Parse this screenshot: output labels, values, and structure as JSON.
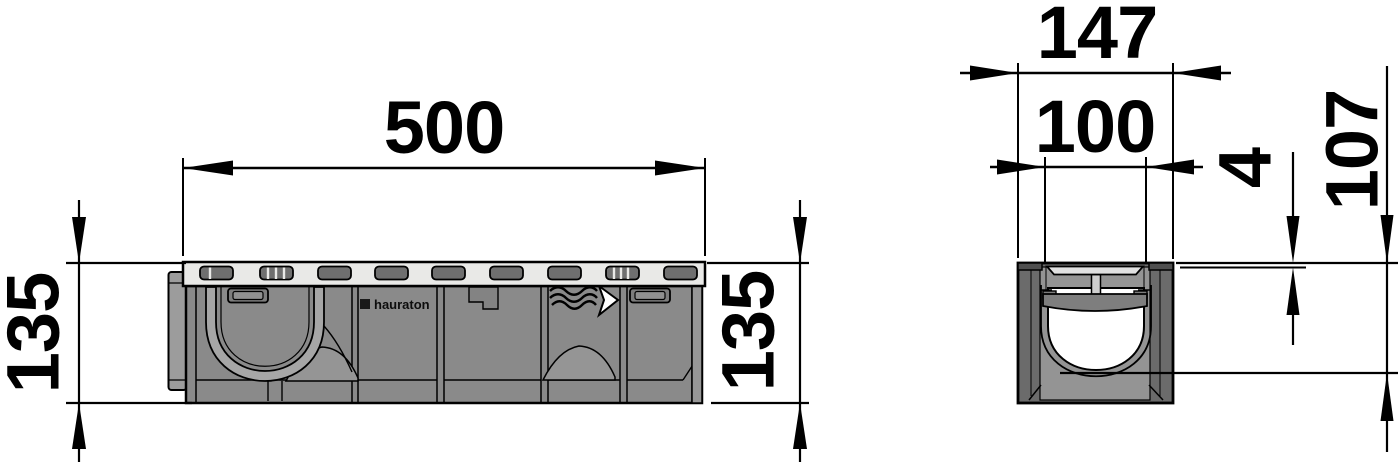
{
  "drawing": {
    "brand": "hauraton",
    "side_view": {
      "length": "500",
      "height": "135",
      "height_right": "135"
    },
    "cross_section": {
      "overall_width": "147",
      "clear_opening": "100",
      "edge_offset": "4",
      "depth": "107"
    },
    "colors": {
      "line": "#000000",
      "body_gray": "#8a8a8a",
      "grate_gray": "#e9e9e7",
      "slot_gray": "#6f6f6f",
      "wall_dark": "#6b6b6b",
      "background": "#ffffff"
    }
  }
}
